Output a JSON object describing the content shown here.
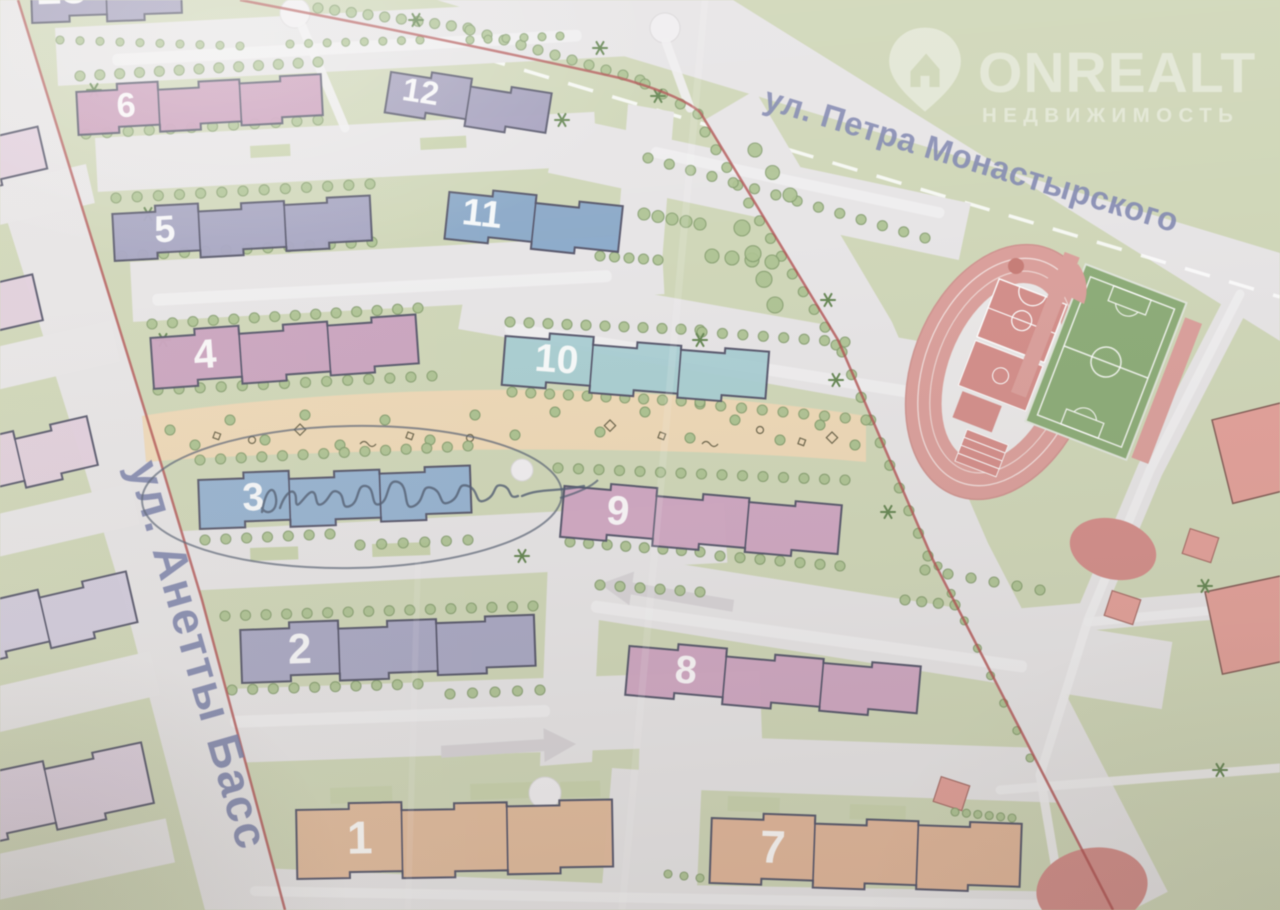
{
  "watermark": {
    "brand": "ONREALT",
    "subtitle": "НЕДВИЖИМОСТЬ",
    "color": "#ffffff",
    "opacity": 0.42
  },
  "streets": {
    "petra": {
      "label": "ул. Петра Монастырского"
    },
    "anetty": {
      "label": "ул. Анетты Басс"
    },
    "label_color": "#7d85b8"
  },
  "annotation": {
    "type": "pen-circle-with-signature",
    "target_building": "3",
    "legible_text": "",
    "ink_color": "#4a5a74"
  },
  "colors": {
    "bg": "#cfd8b2",
    "road": "#e8e5e7",
    "road_light": "#f1eff1",
    "outline": "#50506b",
    "boundary_red": "#c14848",
    "tree_fill": "#a9c487",
    "tree_edge": "#7f9e63",
    "star_tree": "#5e8747",
    "playground": "#f4d8ae",
    "lawn": "#c8d4a6",
    "sport_red": "#e59c96",
    "court_red": "#e08984",
    "field_green": "#86ad6c",
    "school_red": "#ef9d94",
    "number_color": "#ffffff"
  },
  "buildings": [
    {
      "num": "13",
      "x": 30,
      "y": -40,
      "w": 150,
      "h": 56,
      "rot": -2,
      "fill": "#a29cc2",
      "secs": 2
    },
    {
      "num": "6",
      "x": 76,
      "y": 86,
      "w": 245,
      "h": 42,
      "rot": -3,
      "fill": "#d299bf",
      "secs": 3
    },
    {
      "num": "5",
      "x": 112,
      "y": 208,
      "w": 258,
      "h": 46,
      "rot": -3,
      "fill": "#a3a1c8",
      "secs": 3
    },
    {
      "num": "4",
      "x": 150,
      "y": 332,
      "w": 266,
      "h": 50,
      "rot": -4,
      "fill": "#d29fc3",
      "secs": 3
    },
    {
      "num": "12",
      "x": 392,
      "y": 66,
      "w": 162,
      "h": 40,
      "rot": 9,
      "fill": "#a29cc2",
      "secs": 2
    },
    {
      "num": "11",
      "x": 450,
      "y": 186,
      "w": 174,
      "h": 46,
      "rot": 6,
      "fill": "#82a9d2",
      "secs": 2
    },
    {
      "num": "10",
      "x": 506,
      "y": 330,
      "w": 264,
      "h": 48,
      "rot": 4.5,
      "fill": "#a2d0d6",
      "secs": 3
    },
    {
      "num": "3",
      "x": 198,
      "y": 474,
      "w": 272,
      "h": 48,
      "rot": -2,
      "fill": "#8db2da",
      "secs": 3
    },
    {
      "num": "9",
      "x": 565,
      "y": 480,
      "w": 278,
      "h": 50,
      "rot": 5,
      "fill": "#d7a3c6",
      "secs": 3
    },
    {
      "num": "2",
      "x": 240,
      "y": 624,
      "w": 294,
      "h": 52,
      "rot": -2,
      "fill": "#a8a6cb",
      "secs": 3
    },
    {
      "num": "8",
      "x": 630,
      "y": 640,
      "w": 292,
      "h": 48,
      "rot": 5,
      "fill": "#d7a3c6",
      "secs": 3
    },
    {
      "num": "1",
      "x": 296,
      "y": 804,
      "w": 316,
      "h": 68,
      "rot": -1,
      "fill": "#ecb993",
      "secs": 3
    },
    {
      "num": "7",
      "x": 712,
      "y": 812,
      "w": 310,
      "h": 64,
      "rot": 2,
      "fill": "#ecb490",
      "secs": 3
    }
  ],
  "neighbor_buildings": [
    {
      "x": -55,
      "y": 148,
      "w": 95,
      "h": 42,
      "rot": -13,
      "fill": "#e5cfe0",
      "secs": 1
    },
    {
      "x": -70,
      "y": 298,
      "w": 105,
      "h": 46,
      "rot": -13,
      "fill": "#e5cfe0",
      "secs": 1
    },
    {
      "x": -60,
      "y": 448,
      "w": 150,
      "h": 50,
      "rot": -13,
      "fill": "#e5cfe0",
      "secs": 2
    },
    {
      "x": -50,
      "y": 610,
      "w": 180,
      "h": 52,
      "rot": -13,
      "fill": "#d3cbe2",
      "secs": 2
    },
    {
      "x": -55,
      "y": 782,
      "w": 200,
      "h": 62,
      "rot": -12,
      "fill": "#e0cfe2",
      "secs": 2
    }
  ],
  "school_buildings": [
    {
      "x": 1212,
      "y": 420,
      "w": 95,
      "h": 86,
      "rot": -14
    },
    {
      "x": 1205,
      "y": 592,
      "w": 100,
      "h": 84,
      "rot": -12
    }
  ],
  "red_diamonds": [
    [
      1196,
      540,
      18
    ],
    [
      1118,
      602,
      18
    ],
    [
      947,
      788,
      18
    ]
  ],
  "road_bands": [
    [
      55,
      28,
      580,
      58,
      -3
    ],
    [
      95,
      138,
      500,
      54,
      -3
    ],
    [
      130,
      262,
      532,
      60,
      -3
    ],
    [
      165,
      532,
      560,
      60,
      -3
    ],
    [
      200,
      690,
      560,
      74,
      -2
    ],
    [
      560,
      116,
      420,
      58,
      12
    ],
    [
      470,
      262,
      560,
      68,
      10
    ],
    [
      560,
      545,
      620,
      68,
      9
    ],
    [
      640,
      734,
      430,
      54,
      2
    ]
  ],
  "road_polys": [
    [
      [
        628,
        104
      ],
      [
        674,
        112
      ],
      [
        662,
        262
      ],
      [
        616,
        254
      ]
    ],
    [
      [
        548,
        560
      ],
      [
        602,
        556
      ],
      [
        592,
        762
      ],
      [
        540,
        766
      ]
    ],
    [
      [
        612,
        768
      ],
      [
        702,
        774
      ],
      [
        696,
        910
      ],
      [
        600,
        910
      ]
    ],
    [
      [
        215,
        866
      ],
      [
        620,
        884
      ],
      [
        1132,
        893
      ],
      [
        1132,
        910
      ],
      [
        205,
        910
      ]
    ]
  ],
  "parking_bars": [
    [
      112,
      54,
      470,
      12,
      -3
    ],
    [
      152,
      294,
      460,
      12,
      -3
    ],
    [
      230,
      716,
      320,
      12,
      -2
    ],
    [
      506,
      322,
      420,
      12,
      9
    ],
    [
      592,
      600,
      440,
      12,
      8
    ],
    [
      250,
      886,
      800,
      10,
      1
    ],
    [
      652,
      146,
      300,
      11,
      12
    ]
  ],
  "arrows": [
    [
      600,
      584,
      8,
      0
    ],
    [
      576,
      744,
      -2,
      1
    ]
  ],
  "lawn_patches": [
    [
      330,
      788,
      62,
      16,
      -2
    ],
    [
      470,
      784,
      66,
      16,
      -2
    ],
    [
      560,
      782,
      40,
      16,
      -2
    ],
    [
      250,
      548,
      48,
      13,
      -2
    ],
    [
      372,
      544,
      58,
      13,
      -2
    ],
    [
      728,
      796,
      52,
      15,
      2
    ],
    [
      850,
      804,
      56,
      15,
      2
    ],
    [
      250,
      146,
      40,
      12,
      -3
    ],
    [
      420,
      138,
      46,
      12,
      -3
    ]
  ],
  "tree_rows": [
    [
      318,
      8,
      468,
      28,
      10,
      5
    ],
    [
      470,
      30,
      640,
      80,
      11,
      5
    ],
    [
      645,
      84,
      698,
      114,
      4,
      5
    ],
    [
      705,
      132,
      836,
      345,
      13,
      5
    ],
    [
      842,
      352,
      928,
      556,
      10,
      5
    ],
    [
      938,
      566,
      1030,
      758,
      8,
      4
    ],
    [
      80,
      76,
      318,
      62,
      13,
      5
    ],
    [
      86,
      134,
      318,
      120,
      12,
      5
    ],
    [
      116,
      198,
      370,
      184,
      13,
      5
    ],
    [
      122,
      256,
      372,
      242,
      13,
      5
    ],
    [
      152,
      324,
      418,
      308,
      14,
      5
    ],
    [
      158,
      390,
      432,
      376,
      14,
      5
    ],
    [
      700,
      404,
      866,
      420,
      9,
      5
    ],
    [
      200,
      460,
      468,
      446,
      14,
      5
    ],
    [
      558,
      468,
      845,
      480,
      15,
      5
    ],
    [
      205,
      540,
      330,
      534,
      7,
      5
    ],
    [
      360,
      545,
      468,
      540,
      6,
      5
    ],
    [
      225,
      616,
      533,
      606,
      16,
      5
    ],
    [
      232,
      690,
      418,
      684,
      10,
      5
    ],
    [
      450,
      694,
      540,
      690,
      5,
      5
    ],
    [
      648,
      158,
      925,
      238,
      14,
      5
    ],
    [
      600,
      256,
      658,
      260,
      5,
      5
    ],
    [
      644,
      214,
      700,
      224,
      5,
      6
    ],
    [
      712,
      256,
      772,
      262,
      4,
      7
    ],
    [
      510,
      322,
      700,
      330,
      11,
      5
    ],
    [
      702,
      332,
      845,
      342,
      8,
      5
    ],
    [
      512,
      392,
      700,
      402,
      11,
      5
    ],
    [
      570,
      542,
      700,
      552,
      8,
      5
    ],
    [
      720,
      556,
      840,
      566,
      7,
      5
    ],
    [
      925,
      570,
      1040,
      590,
      6,
      5
    ],
    [
      600,
      585,
      700,
      592,
      6,
      5
    ],
    [
      905,
      600,
      955,
      605,
      4,
      5
    ],
    [
      955,
      812,
      1012,
      818,
      6,
      4
    ],
    [
      668,
      874,
      700,
      878,
      3,
      4
    ],
    [
      60,
      40,
      240,
      46,
      10,
      4
    ],
    [
      290,
      44,
      420,
      40,
      8,
      4
    ],
    [
      470,
      40,
      560,
      36,
      6,
      4
    ],
    [
      742,
      228,
      775,
      305,
      4,
      8
    ],
    [
      755,
      150,
      790,
      195,
      3,
      7
    ]
  ],
  "star_trees": [
    [
      94,
      90
    ],
    [
      148,
      214
    ],
    [
      163,
      340
    ],
    [
      300,
      640
    ],
    [
      522,
      556
    ],
    [
      836,
      380
    ],
    [
      888,
      512
    ],
    [
      1205,
      586
    ],
    [
      1220,
      770
    ],
    [
      658,
      96
    ],
    [
      600,
      48
    ],
    [
      562,
      120
    ],
    [
      416,
      20
    ],
    [
      700,
      340
    ],
    [
      828,
      300
    ]
  ],
  "playground_trees": [
    [
      170,
      430
    ],
    [
      195,
      445
    ],
    [
      230,
      420
    ],
    [
      265,
      440
    ],
    [
      305,
      415
    ],
    [
      340,
      445
    ],
    [
      385,
      420
    ],
    [
      430,
      440
    ],
    [
      475,
      415
    ],
    [
      515,
      435
    ],
    [
      555,
      412
    ],
    [
      600,
      432
    ],
    [
      645,
      412
    ],
    [
      690,
      438
    ],
    [
      735,
      420
    ],
    [
      780,
      440
    ],
    [
      820,
      425
    ],
    [
      855,
      445
    ]
  ],
  "playground_icons": [
    [
      215,
      432,
      0
    ],
    [
      252,
      440,
      1
    ],
    [
      300,
      424,
      2
    ],
    [
      360,
      444,
      3
    ],
    [
      408,
      432,
      0
    ],
    [
      470,
      438,
      1
    ],
    [
      610,
      420,
      2
    ],
    [
      660,
      432,
      0
    ],
    [
      702,
      444,
      3
    ],
    [
      760,
      430,
      1
    ],
    [
      800,
      438,
      0
    ],
    [
      832,
      432,
      2
    ]
  ],
  "roundabouts": [
    [
      295,
      13,
      15
    ],
    [
      665,
      28,
      15
    ],
    [
      545,
      793,
      16
    ],
    [
      522,
      470,
      11
    ]
  ],
  "white_paths": [
    [
      [
        302,
        26
      ],
      [
        345,
        128
      ]
    ],
    [
      [
        666,
        42
      ],
      [
        690,
        108
      ]
    ],
    [
      [
        1240,
        294
      ],
      [
        1150,
        470
      ],
      [
        1088,
        620
      ],
      [
        1040,
        775
      ],
      [
        1062,
        905
      ]
    ],
    [
      [
        1088,
        622
      ],
      [
        1280,
        604
      ]
    ],
    [
      [
        1000,
        790
      ],
      [
        1280,
        768
      ]
    ]
  ],
  "neighbor_parking": [
    [
      -70,
      200,
      160,
      40,
      -13
    ],
    [
      -60,
      360,
      175,
      42,
      -13
    ],
    [
      -50,
      525,
      185,
      42,
      -13
    ],
    [
      -40,
      695,
      195,
      45,
      -13
    ],
    [
      -30,
      860,
      200,
      45,
      -12
    ]
  ]
}
